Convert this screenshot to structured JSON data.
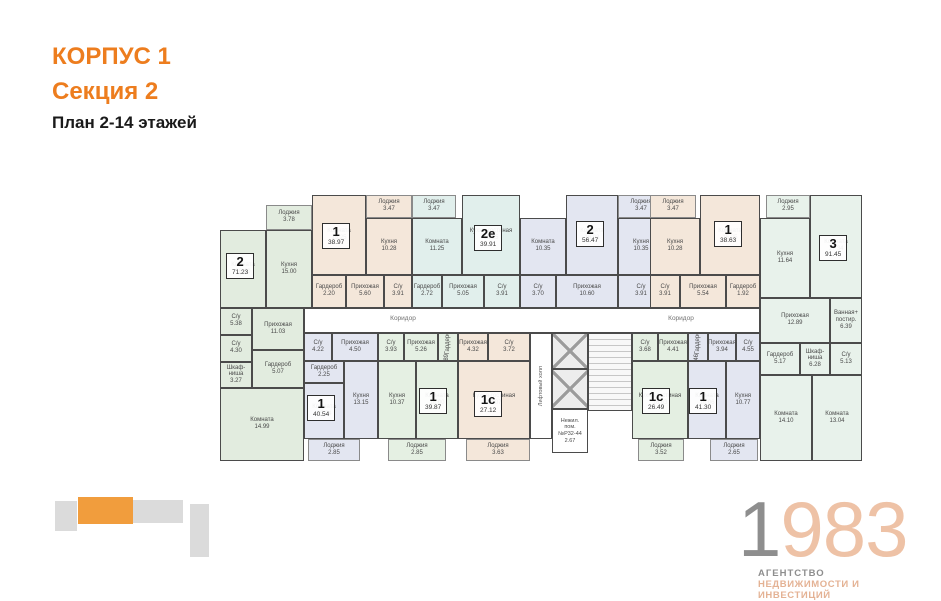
{
  "header": {
    "corpus": "КОРПУС 1",
    "section": "Секция 2",
    "plan_title": "План 2-14 этажей"
  },
  "colors": {
    "accent_orange": "#ED7D1E",
    "minimap_orange": "#F19D3D",
    "minimap_gray": "#DBDBDB",
    "wall": "#4b4b4b",
    "apt_green": "#E2ECDF",
    "apt_beige": "#F4E7DA",
    "apt_cyan": "#E1EFEC",
    "apt_blue": "#E3E6F1",
    "apt_mint": "#E8F2EB",
    "logo_gray": "#8e8e8e",
    "logo_salmon": "#EEC2A6"
  },
  "plan": {
    "apartments": [
      {
        "num": "2",
        "area": "71.23",
        "color": "#E2ECDF",
        "badge": {
          "x": 8,
          "y": 70
        },
        "rooms": [
          {
            "name": "Лоджия",
            "area": "3.78",
            "x": 48,
            "y": 22,
            "w": 46,
            "h": 25,
            "loggia": true
          },
          {
            "name": "Комната",
            "area": "16.80",
            "x": 2,
            "y": 47,
            "w": 46,
            "h": 78
          },
          {
            "name": "Кухня",
            "area": "15.00",
            "x": 48,
            "y": 47,
            "w": 46,
            "h": 78
          },
          {
            "name": "Прихожая",
            "area": "11.03",
            "x": 34,
            "y": 125,
            "w": 52,
            "h": 42
          },
          {
            "name": "Гардероб",
            "area": "5.07",
            "x": 34,
            "y": 167,
            "w": 52,
            "h": 38
          },
          {
            "name": "С/у",
            "area": "5.38",
            "x": 2,
            "y": 125,
            "w": 32,
            "h": 27
          },
          {
            "name": "С/у",
            "area": "4.30",
            "x": 2,
            "y": 152,
            "w": 32,
            "h": 27
          },
          {
            "name": "Шкаф-ниша",
            "area": "3.27",
            "x": 2,
            "y": 179,
            "w": 32,
            "h": 26
          },
          {
            "name": "Комната",
            "area": "14.99",
            "x": 2,
            "y": 205,
            "w": 84,
            "h": 73
          }
        ]
      },
      {
        "num": "1",
        "area": "38.97",
        "color": "#F4E7DA",
        "badge": {
          "x": 104,
          "y": 40
        },
        "rooms": [
          {
            "name": "Комната",
            "area": "15.25",
            "x": 94,
            "y": 12,
            "w": 54,
            "h": 80
          },
          {
            "name": "Лоджия",
            "area": "3.47",
            "x": 148,
            "y": 12,
            "w": 46,
            "h": 23,
            "loggia": true
          },
          {
            "name": "Кухня",
            "area": "10.28",
            "x": 148,
            "y": 35,
            "w": 46,
            "h": 57
          },
          {
            "name": "Гардероб",
            "area": "2.20",
            "x": 94,
            "y": 92,
            "w": 34,
            "h": 33
          },
          {
            "name": "Прихожая",
            "area": "5.60",
            "x": 128,
            "y": 92,
            "w": 38,
            "h": 33
          },
          {
            "name": "С/у",
            "area": "3.91",
            "x": 166,
            "y": 92,
            "w": 28,
            "h": 33
          }
        ]
      },
      {
        "num": "2е",
        "area": "39.91",
        "color": "#E1EFEC",
        "badge": {
          "x": 256,
          "y": 42
        },
        "rooms": [
          {
            "name": "Лоджия",
            "area": "3.47",
            "x": 194,
            "y": 12,
            "w": 44,
            "h": 23,
            "loggia": true
          },
          {
            "name": "Комната",
            "area": "11.25",
            "x": 194,
            "y": 35,
            "w": 50,
            "h": 57
          },
          {
            "name": "Кухня-гостиная",
            "area": "15.25",
            "x": 244,
            "y": 12,
            "w": 58,
            "h": 80
          },
          {
            "name": "Гардероб",
            "area": "2.72",
            "x": 194,
            "y": 92,
            "w": 30,
            "h": 33
          },
          {
            "name": "Прихожая",
            "area": "5.05",
            "x": 224,
            "y": 92,
            "w": 42,
            "h": 33
          },
          {
            "name": "С/у",
            "area": "3.91",
            "x": 266,
            "y": 92,
            "w": 36,
            "h": 33
          }
        ]
      },
      {
        "num": "2",
        "area": "56.47",
        "color": "#E3E6F1",
        "badge": {
          "x": 358,
          "y": 38
        },
        "rooms": [
          {
            "name": "Комната",
            "area": "10.35",
            "x": 302,
            "y": 35,
            "w": 46,
            "h": 57
          },
          {
            "name": "Комната",
            "area": "16.03",
            "x": 348,
            "y": 12,
            "w": 52,
            "h": 80
          },
          {
            "name": "Лоджия",
            "area": "3.47",
            "x": 400,
            "y": 12,
            "w": 46,
            "h": 23,
            "loggia": true
          },
          {
            "name": "Кухня",
            "area": "10.35",
            "x": 400,
            "y": 35,
            "w": 46,
            "h": 57
          },
          {
            "name": "С/у",
            "area": "3.70",
            "x": 302,
            "y": 92,
            "w": 36,
            "h": 33
          },
          {
            "name": "Прихожая",
            "area": "10.60",
            "x": 338,
            "y": 92,
            "w": 62,
            "h": 33
          },
          {
            "name": "С/у",
            "area": "3.91",
            "x": 400,
            "y": 92,
            "w": 46,
            "h": 33
          }
        ]
      },
      {
        "num": "1",
        "area": "38.63",
        "color": "#F4E7DA",
        "badge": {
          "x": 496,
          "y": 38
        },
        "rooms": [
          {
            "name": "Лоджия",
            "area": "3.47",
            "x": 432,
            "y": 12,
            "w": 46,
            "h": 23,
            "loggia": true
          },
          {
            "name": "Кухня",
            "area": "10.28",
            "x": 432,
            "y": 35,
            "w": 50,
            "h": 57
          },
          {
            "name": "Комната",
            "area": "15.25",
            "x": 482,
            "y": 12,
            "w": 60,
            "h": 80
          },
          {
            "name": "С/у",
            "area": "3.91",
            "x": 432,
            "y": 92,
            "w": 30,
            "h": 33
          },
          {
            "name": "Прихожая",
            "area": "5.54",
            "x": 462,
            "y": 92,
            "w": 46,
            "h": 33
          },
          {
            "name": "Гардероб",
            "area": "1.92",
            "x": 508,
            "y": 92,
            "w": 34,
            "h": 33
          }
        ]
      },
      {
        "num": "3",
        "area": "91.45",
        "color": "#E8F2EB",
        "badge": {
          "x": 601,
          "y": 52
        },
        "rooms": [
          {
            "name": "Лоджия",
            "area": "2.95",
            "x": 548,
            "y": 12,
            "w": 44,
            "h": 23,
            "loggia": true
          },
          {
            "name": "Кухня",
            "area": "11.64",
            "x": 542,
            "y": 35,
            "w": 50,
            "h": 80
          },
          {
            "name": "Комната",
            "area": "17.34",
            "x": 592,
            "y": 12,
            "w": 52,
            "h": 103
          },
          {
            "name": "Прихожая",
            "area": "12.89",
            "x": 542,
            "y": 115,
            "w": 70,
            "h": 45
          },
          {
            "name": "Ванная+ постир.",
            "area": "6.39",
            "x": 612,
            "y": 115,
            "w": 32,
            "h": 45
          },
          {
            "name": "Гардероб",
            "area": "5.17",
            "x": 542,
            "y": 160,
            "w": 40,
            "h": 32
          },
          {
            "name": "Шкаф-ниша",
            "area": "6.28",
            "x": 582,
            "y": 160,
            "w": 30,
            "h": 32
          },
          {
            "name": "С/у",
            "area": "5.13",
            "x": 612,
            "y": 160,
            "w": 32,
            "h": 32
          },
          {
            "name": "Комната",
            "area": "14.10",
            "x": 542,
            "y": 192,
            "w": 52,
            "h": 86
          },
          {
            "name": "Комната",
            "area": "13.04",
            "x": 594,
            "y": 192,
            "w": 50,
            "h": 86
          }
        ]
      },
      {
        "num": "1",
        "area": "40.54",
        "color": "#E3E6F1",
        "badge": {
          "x": 89,
          "y": 212
        },
        "rooms": [
          {
            "name": "С/у",
            "area": "4.22",
            "x": 86,
            "y": 150,
            "w": 28,
            "h": 28
          },
          {
            "name": "Прихожая",
            "area": "4.50",
            "x": 114,
            "y": 150,
            "w": 46,
            "h": 28
          },
          {
            "name": "Гардероб",
            "area": "2.25",
            "x": 86,
            "y": 178,
            "w": 40,
            "h": 22
          },
          {
            "name": "Комната",
            "area": "15.04",
            "x": 86,
            "y": 200,
            "w": 40,
            "h": 56
          },
          {
            "name": "Кухня",
            "area": "13.15",
            "x": 126,
            "y": 178,
            "w": 34,
            "h": 78
          },
          {
            "name": "Лоджия",
            "area": "2.85",
            "x": 90,
            "y": 256,
            "w": 52,
            "h": 22,
            "loggia": true
          }
        ]
      },
      {
        "num": "1",
        "area": "39.87",
        "color": "#E5F0E3",
        "badge": {
          "x": 201,
          "y": 205
        },
        "rooms": [
          {
            "name": "С/у",
            "area": "3.93",
            "x": 160,
            "y": 150,
            "w": 26,
            "h": 28
          },
          {
            "name": "Прихожая",
            "area": "5.26",
            "x": 186,
            "y": 150,
            "w": 34,
            "h": 28
          },
          {
            "name": "Гардероб",
            "area": "2.89",
            "x": 220,
            "y": 150,
            "w": 20,
            "h": 28,
            "vert": true
          },
          {
            "name": "Кухня",
            "area": "10.37",
            "x": 160,
            "y": 178,
            "w": 38,
            "h": 78
          },
          {
            "name": "Комната",
            "area": "16.00",
            "x": 198,
            "y": 178,
            "w": 42,
            "h": 78
          },
          {
            "name": "Лоджия",
            "area": "2.85",
            "x": 170,
            "y": 256,
            "w": 58,
            "h": 22,
            "loggia": true
          }
        ]
      },
      {
        "num": "1с",
        "area": "27.12",
        "color": "#F4E7DA",
        "badge": {
          "x": 256,
          "y": 208
        },
        "rooms": [
          {
            "name": "Прихожая",
            "area": "4.32",
            "x": 240,
            "y": 150,
            "w": 30,
            "h": 28
          },
          {
            "name": "С/у",
            "area": "3.72",
            "x": 270,
            "y": 150,
            "w": 42,
            "h": 28
          },
          {
            "name": "Кухня-гостиная",
            "area": "17.07",
            "x": 240,
            "y": 178,
            "w": 72,
            "h": 78
          },
          {
            "name": "Лоджия",
            "area": "3.63",
            "x": 248,
            "y": 256,
            "w": 64,
            "h": 22,
            "loggia": true
          }
        ]
      },
      {
        "num": "1с",
        "area": "26.49",
        "color": "#E4EFE2",
        "badge": {
          "x": 424,
          "y": 205
        },
        "rooms": [
          {
            "name": "С/у",
            "area": "3.68",
            "x": 414,
            "y": 150,
            "w": 26,
            "h": 28
          },
          {
            "name": "Прихожая",
            "area": "4.41",
            "x": 440,
            "y": 150,
            "w": 30,
            "h": 28
          },
          {
            "name": "Кухня-гостиная",
            "area": "16.63",
            "x": 414,
            "y": 178,
            "w": 56,
            "h": 78
          },
          {
            "name": "Лоджия",
            "area": "3.52",
            "x": 420,
            "y": 256,
            "w": 46,
            "h": 22,
            "loggia": true
          }
        ]
      },
      {
        "num": "1",
        "area": "41.30",
        "color": "#E3E6F1",
        "badge": {
          "x": 471,
          "y": 205
        },
        "rooms": [
          {
            "name": "Гардероб",
            "area": "2.46",
            "x": 470,
            "y": 150,
            "w": 20,
            "h": 28,
            "vert": true
          },
          {
            "name": "Прихожая",
            "area": "3.94",
            "x": 490,
            "y": 150,
            "w": 28,
            "h": 28
          },
          {
            "name": "С/у",
            "area": "4.55",
            "x": 518,
            "y": 150,
            "w": 24,
            "h": 28
          },
          {
            "name": "Комната",
            "area": "16.06",
            "x": 470,
            "y": 178,
            "w": 38,
            "h": 78
          },
          {
            "name": "Кухня",
            "area": "10.77",
            "x": 508,
            "y": 178,
            "w": 34,
            "h": 78
          },
          {
            "name": "Лоджия",
            "area": "2.65",
            "x": 492,
            "y": 256,
            "w": 48,
            "h": 22,
            "loggia": true
          }
        ]
      }
    ],
    "common": [
      {
        "kind": "corridor",
        "x": 86,
        "y": 125,
        "w": 456,
        "h": 25
      },
      {
        "kind": "text",
        "text": "Коридор",
        "x": 150,
        "y": 132,
        "w": 70
      },
      {
        "kind": "text",
        "text": "Коридор",
        "x": 428,
        "y": 132,
        "w": 70
      },
      {
        "kind": "lifthall",
        "text": "Лифтовый холл",
        "x": 312,
        "y": 150,
        "w": 22,
        "h": 106
      },
      {
        "kind": "elevator",
        "x": 334,
        "y": 150,
        "w": 36,
        "h": 36
      },
      {
        "kind": "elevator",
        "x": 334,
        "y": 186,
        "w": 36,
        "h": 40
      },
      {
        "kind": "service",
        "lines": [
          "Нежил.",
          "пом.",
          "№Р32-44",
          "2.67"
        ],
        "x": 334,
        "y": 226,
        "w": 36,
        "h": 44
      },
      {
        "kind": "stairs",
        "x": 370,
        "y": 150,
        "w": 44,
        "h": 78
      }
    ]
  },
  "minimap": {
    "blocks": [
      {
        "x": 55,
        "y": 501,
        "w": 22,
        "h": 30,
        "highlight": false
      },
      {
        "x": 78,
        "y": 497,
        "w": 55,
        "h": 27,
        "highlight": true
      },
      {
        "x": 133,
        "y": 500,
        "w": 26,
        "h": 23,
        "highlight": false
      },
      {
        "x": 159,
        "y": 500,
        "w": 24,
        "h": 23,
        "highlight": false
      },
      {
        "x": 190,
        "y": 504,
        "w": 19,
        "h": 53,
        "highlight": false
      }
    ]
  },
  "logo": {
    "year_gray": "1",
    "year_accent": "983",
    "line1": "АГЕНТСТВО",
    "line2": "НЕДВИЖИМОСТИ И ИНВЕСТИЦИЙ"
  }
}
